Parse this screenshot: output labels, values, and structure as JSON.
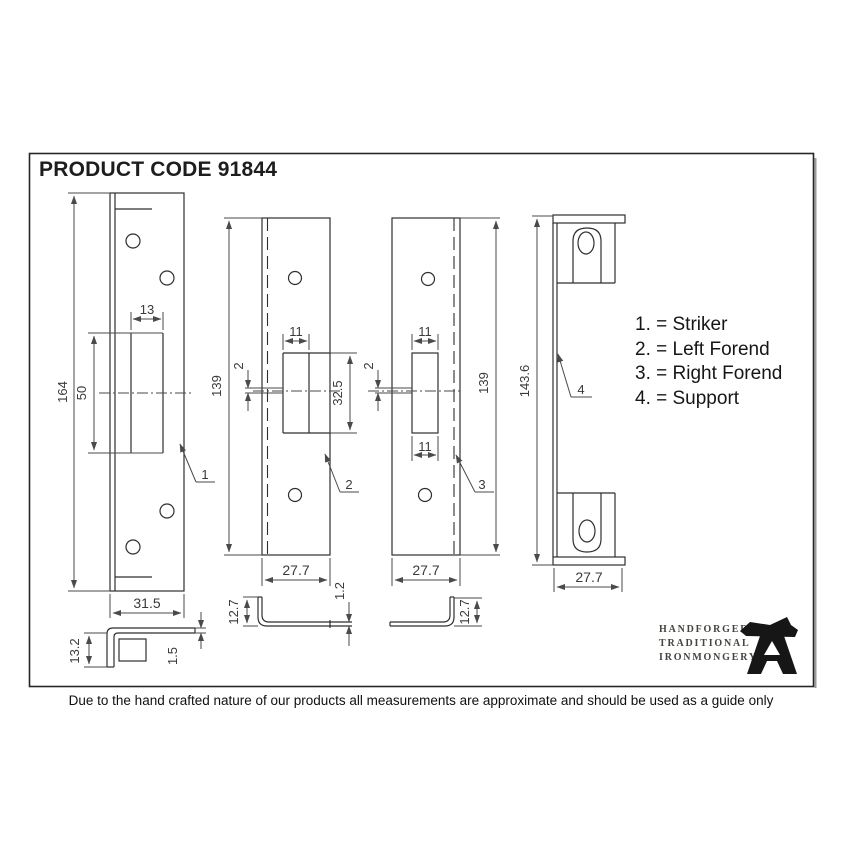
{
  "title": "PRODUCT CODE 91844",
  "legend": {
    "items": [
      "1. = Striker",
      "2. = Left Forend",
      "3. = Right Forend",
      "4. = Support"
    ]
  },
  "drawings": {
    "striker": {
      "callout": "1",
      "height": "164",
      "slot_height": "50",
      "slot_width": "13",
      "width": "31.5",
      "profile_height": "13.2",
      "profile_thickness": "1.5"
    },
    "left_forend": {
      "callout": "2",
      "height": "139",
      "slot_width": "11",
      "slot_height": "32.5",
      "slot_offset": "2",
      "width": "27.7",
      "profile_height": "12.7",
      "profile_thickness": "1.2"
    },
    "right_forend": {
      "callout": "3",
      "height": "139",
      "slot_width_top": "11",
      "slot_width_bottom": "11",
      "slot_offset": "2",
      "width": "27.7",
      "profile_height": "12.7"
    },
    "support": {
      "callout": "4",
      "height": "143.6",
      "width": "27.7"
    }
  },
  "branding": {
    "lines": [
      "HANDFORGED",
      "TRADITIONAL",
      "IRONMONGERY"
    ],
    "logo": "anvil-icon"
  },
  "disclaimer": "Due to the hand crafted nature of our products all measurements are approximate and should be used as a guide only",
  "colors": {
    "line": "#333333",
    "dim_text": "#3a3a3a",
    "background": "#ffffff"
  }
}
